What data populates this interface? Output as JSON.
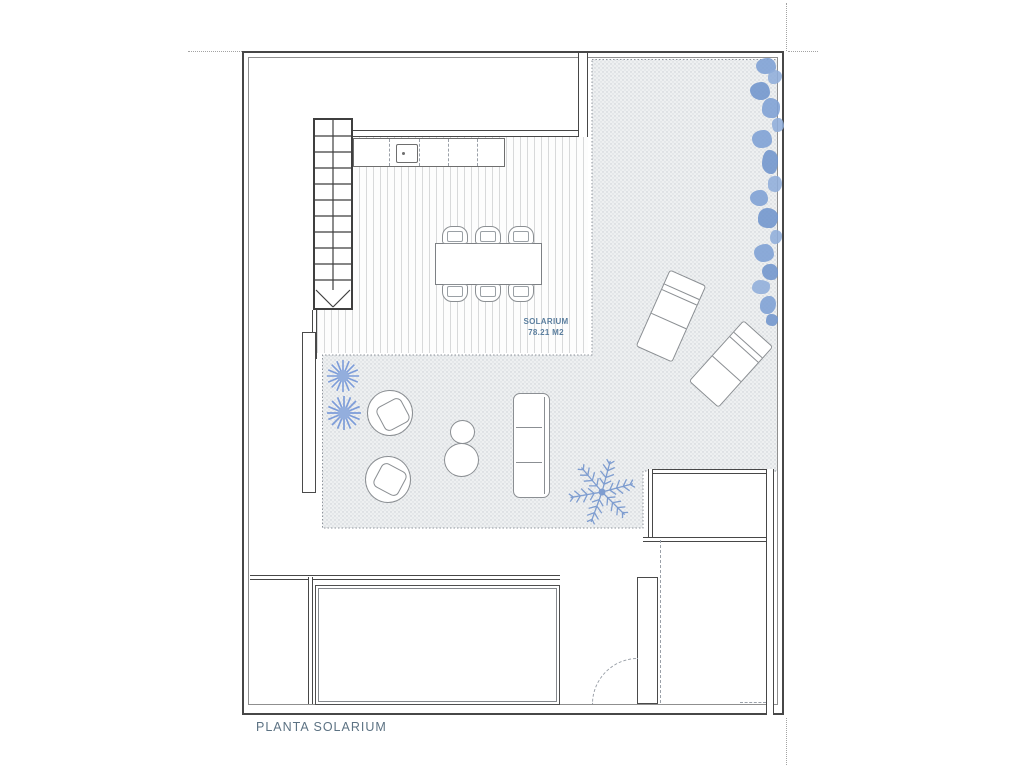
{
  "drawing": {
    "type": "architectural-floor-plan",
    "title": "PLANTA SOLARIUM",
    "room_label": {
      "line1": "SOLARIUM",
      "line2": "78.21 M2"
    }
  },
  "colors": {
    "room_label_blue": "#5b7e9e",
    "title_blue": "#5c7283",
    "plant_blue": "#7d9fd4",
    "wall_dark": "#474747",
    "furniture_line": "#8b8f93",
    "terrace_texture_bg": "#eef0f1",
    "terrace_texture_dot": "#c9cdd3"
  },
  "elements": [
    "property-boundary",
    "reference-dotted-lines",
    "staircase",
    "stair-direction-arrow",
    "outdoor-kitchen-counter",
    "sink",
    "wood-deck-area",
    "tiled-terrace-area",
    "dining-table",
    "dining-chair-x6",
    "sun-lounger-x2",
    "tub-armchair-x2",
    "side-table-small",
    "side-table-large",
    "sofa-3-seat",
    "shrub-plant-x2",
    "palm-plant",
    "hedge-strip",
    "pool",
    "swing-door",
    "lower-rooms"
  ]
}
